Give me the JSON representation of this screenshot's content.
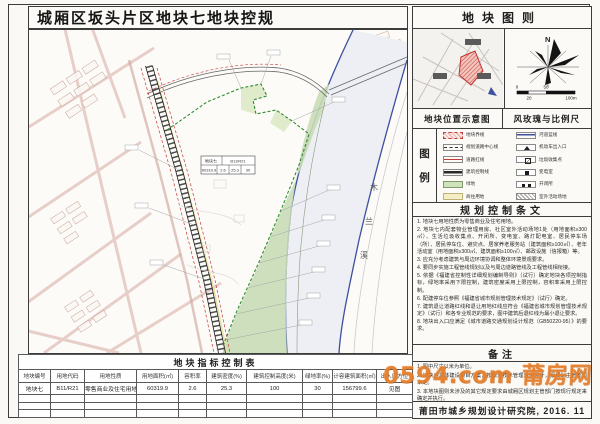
{
  "title": "城厢区坂头片区地块七地块控规",
  "colors": {
    "accent_orange": "#e87f2a",
    "river_blue": "#3d4f9e",
    "parcel_green": "#2e8b2e",
    "road_pink": "#d6aba3",
    "legend_red": "#c43b3b"
  },
  "map": {
    "river_chars": [
      "木",
      "兰",
      "溪"
    ],
    "info_box": {
      "plot": "地块七",
      "code": "B11/R21",
      "area": "60319.9",
      "far": "2.6",
      "density": "25.3",
      "green": "30"
    }
  },
  "right_panel": {
    "plot_diagram_title": "地块图则",
    "location_label": "地块位置示意图",
    "windrose_label": "风玫瑰与比例尺",
    "windrose": {
      "north": "N",
      "scale_0": "0",
      "scale_50": "50",
      "scale_20": "20",
      "scale_100": "100m"
    },
    "legend": {
      "title_chars": [
        "图",
        "例"
      ],
      "left": [
        "地块界线",
        "规划道路中心线",
        "道路红线",
        "建筑控制线",
        "绿地",
        "商住用地"
      ],
      "right": [
        "河道蓝线",
        "机动车出入口",
        "垃圾收集点",
        "变电室",
        "开闭所",
        "室外活动场地"
      ]
    },
    "provisions": {
      "title": "规划控制条文",
      "items": [
        "1. 地块七用地性质为零售商业及住宅用地。",
        "2. 地块七内配套物业管理用房、社区室外活动场地1处（用地面积≥300㎡）、生活垃圾收集点、开闭所、变电室、路灯配电室、居民停车场（所）、居民停车位、避灾点、居家养老服务站（建筑面积≥100㎡）、老年活动室（用地面积≥300㎡、建筑面积≥100㎡）、邮政设施（信报箱）等。",
        "3. 应充分考虑建筑与周边环境协调和整体环境景观要求。",
        "4. 要同步实施工程管线规划以及与周边道路管线及工程管线相衔接。",
        "5. 依据《福建省控制性详细规划编制导则》（试行）确定地块各项控制指标，绿地率采用下限控制，建筑密度采用上限控制，容积率采用上限控制。",
        "6. 配建停车位参照《福建省城市规划管理技术规定》（试行）确定。",
        "7. 建筑退让道路红线和退让用地红线应符合《福建省城市规划管理技术规定》（试行）和各专业规范的要求，图中建筑后退红线为最小退让要求。",
        "8. 地块出入口应满足《城市道路交通规划设计规范（GB50220-95）》的要求。"
      ]
    },
    "notes": {
      "title": "备注",
      "lines": [
        "1. 图中尺寸以米为单位。",
        "2. 地块内具体建设项目方案，按规划技术管理规定设计，报规划主管部门审定。",
        "3. 本地块图则未涉及的其它规定要求由城厢区规划主管部门按现行规定来确定并执行。"
      ]
    },
    "institute": "莆田市城乡规划设计研究院, 2016. 11"
  },
  "indicator_table": {
    "title": "地块指标控制表",
    "headers": [
      "地块编号",
      "用地代码",
      "用地性质",
      "用地面积(㎡)",
      "容积率",
      "建筑密度(%)",
      "建筑控制高度(米)",
      "绿地率(%)",
      "计容建筑面积(㎡)",
      "出入口方位"
    ],
    "row": [
      "地块七",
      "B11/R21",
      "零售商业及住宅用地",
      "60319.9",
      "2.6",
      "25.3",
      "100",
      "30",
      "156799.6",
      "见图"
    ]
  },
  "watermark": "0594.com 莆房网"
}
